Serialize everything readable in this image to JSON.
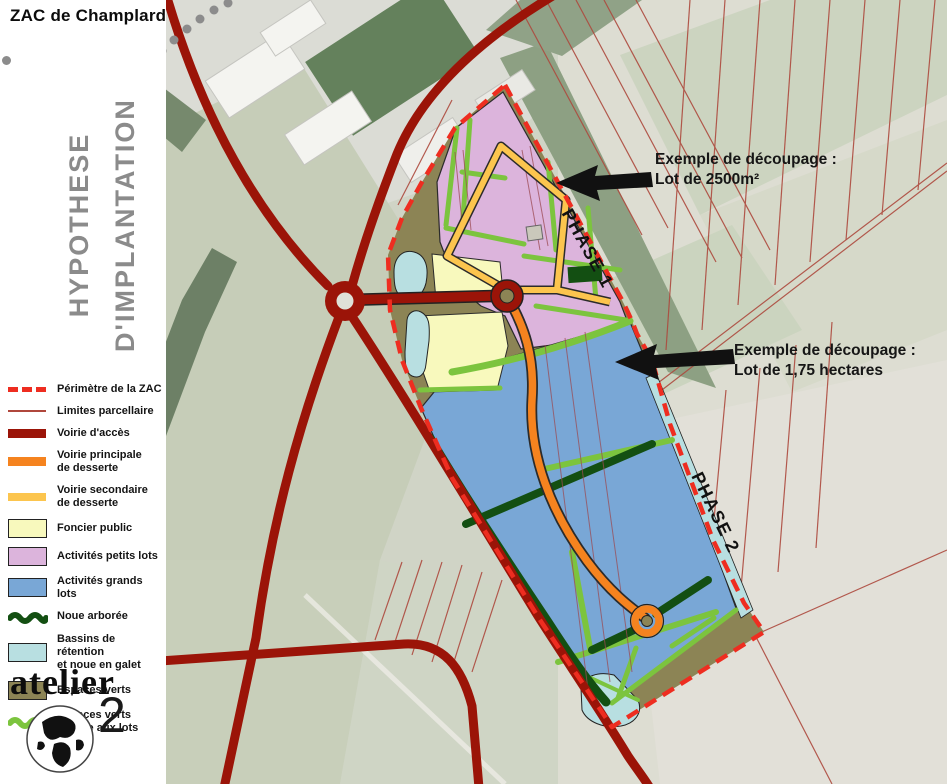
{
  "title": "ZAC de Champlard",
  "heading": {
    "line1": "HYPOTHESE",
    "line2": "D'IMPLANTATION"
  },
  "legend": {
    "items": [
      {
        "label": "Périmètre de la ZAC",
        "swatch": "dashed-line",
        "color": "#ee2d20"
      },
      {
        "label": "Limites parcellaire",
        "swatch": "thin-line",
        "color": "#b0473c"
      },
      {
        "label": "Voirie d'accès",
        "swatch": "thick-line",
        "color": "#9b1408"
      },
      {
        "label": "Voirie principale\nde desserte",
        "swatch": "thick-line",
        "color": "#f5831f"
      },
      {
        "label": "Voirie secondaire\nde desserte",
        "swatch": "thick-line",
        "color": "#fcc54e"
      },
      {
        "label": "Foncier public",
        "swatch": "box",
        "color": "#f8f9bd"
      },
      {
        "label": "Activités petits lots",
        "swatch": "box",
        "color": "#dcb4dc"
      },
      {
        "label": "Activités grands lots",
        "swatch": "box",
        "color": "#79a7d6"
      },
      {
        "label": "Noue arborée",
        "swatch": "wave",
        "color": "#134f12"
      },
      {
        "label": "Bassins de rétention\net noue en galet",
        "swatch": "box",
        "color": "#b8dfe1"
      },
      {
        "label": "Espaces verts",
        "swatch": "box",
        "color": "#8c8455"
      },
      {
        "label": "Espaces verts\ninterne aux lots",
        "swatch": "wave",
        "color": "#7cc43e"
      }
    ]
  },
  "annotations": {
    "a1_line1": "Exemple de découpage :",
    "a1_line2": "Lot de 2500m²",
    "a2_line1": "Exemple de découpage :",
    "a2_line2": "Lot de 1,75 hectares"
  },
  "phases": {
    "phase1": "PHASE 1",
    "phase2": "PHASE 2"
  },
  "logo": {
    "name": "atelier",
    "number": "2"
  },
  "colors": {
    "perimeter": "#ee2d20",
    "parcel_line": "#b0473c",
    "access_road": "#9b1408",
    "main_road": "#f5831f",
    "secondary_road": "#fcc54e",
    "public_land": "#f8f9bd",
    "small_lots": "#dcb4dc",
    "large_lots": "#79a7d6",
    "tree_swale": "#134f12",
    "retention_basin": "#b8dfe1",
    "green_space": "#8c8455",
    "lot_green_edge": "#7cc43e",
    "heading_gray": "#8b8b8b"
  }
}
